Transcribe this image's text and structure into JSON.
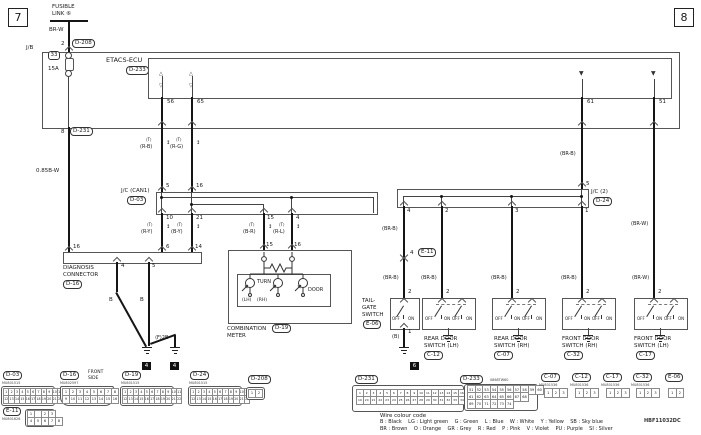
{
  "tabs": {
    "left": "7",
    "right": "8"
  },
  "doc": {
    "code": "HBF11032DC"
  },
  "supply": {
    "fusible1": "FUSIBLE",
    "fusible2": "LINK ⑥",
    "wire": "BR-W",
    "pin": "2",
    "conn": "D-208",
    "jb": "J/B",
    "fuse_no": "33",
    "fuse_rating": "15A",
    "out_pin": "8",
    "out_conn": "D-231",
    "out_wire": "0.85B-W"
  },
  "etacs": {
    "name": "ETACS-ECU",
    "conn": "D-233",
    "pins": {
      "p56": "56",
      "p65": "65",
      "p61": "61",
      "p51": "51"
    }
  },
  "sym": {
    "t": "⟨T⟩",
    "updown": "↕",
    "tri_up": "△",
    "tri_down": "▽",
    "tri_solid": "▼"
  },
  "can": {
    "w56": "(R-B)",
    "w65": "(R-G)",
    "w10": "(R-Y)",
    "w21": "(B-Y)",
    "w15": "(B-R)",
    "w4": "(R-L)"
  },
  "jc1": {
    "name": "J/C (CAN1)",
    "conn": "D-03",
    "top5": "5",
    "top16": "16",
    "b10": "10",
    "b21": "21",
    "b15": "15",
    "b4": "4"
  },
  "jc2": {
    "name": "J/C (2)",
    "conn": "D-24",
    "top5": "5",
    "b4": "4",
    "b2": "2",
    "b3": "3",
    "b1": "1",
    "w_in": "(BR-B)",
    "w_out": "(BR-W)"
  },
  "diag": {
    "name1": "DIAGNOSIS",
    "name2": "CONNECTOR",
    "conn": "D-16",
    "p16": "16",
    "p6": "6",
    "p14": "14",
    "p4": "4",
    "p5": "5",
    "w4": "B",
    "w5": "B",
    "f2b": "⟨F⟩2B",
    "g1": "4",
    "g2": "4"
  },
  "meter": {
    "p15": "15",
    "p16": "16",
    "turn": "TURN",
    "lh": "(LH)",
    "rh": "(RH)",
    "door": "DOOR",
    "name1": "COMBINATION",
    "name2": "METER",
    "conn": "D-19"
  },
  "tailgate": {
    "name1": "TAIL-",
    "name2": "GATE",
    "name3": "SWITCH",
    "conn": "E-06",
    "pin_top": "2",
    "pin_bot": "1",
    "w_top": "(BR-B)",
    "w_mid": "(BR-B)",
    "w_bot": "(B)",
    "off": "OFF",
    "on": "ON",
    "e11_pin": "4",
    "e11_conn": "E-11",
    "gnd": "6"
  },
  "doors": [
    {
      "w": "(BR-B)",
      "pin": "2",
      "name1": "REAR DOOR",
      "name2": "SWITCH (LH)",
      "conn": "C-12",
      "off": "OFF",
      "on": "ON"
    },
    {
      "w": "(BR-B)",
      "pin": "2",
      "name1": "REAR DOOR",
      "name2": "SWITCH (RH)",
      "conn": "C-07",
      "off": "OFF",
      "on": "ON"
    },
    {
      "w": "(BR-B)",
      "pin": "2",
      "name1": "FRONT DOOR",
      "name2": "SWITCH (RH)",
      "conn": "C-32",
      "off": "OFF",
      "on": "ON"
    },
    {
      "w": "(BR-W)",
      "pin": "2",
      "name1": "FRONT DOOR",
      "name2": "SWITCH (LH)",
      "conn": "C-17",
      "off": "OFF",
      "on": "ON"
    }
  ],
  "connectors": {
    "d03": {
      "label": "D-03",
      "code": "MU801515",
      "r1": [
        "1",
        "2",
        "3",
        "4",
        "5",
        "6",
        "7",
        "8",
        "9",
        "10",
        "11"
      ],
      "r2": [
        "12",
        "13",
        "14",
        "15",
        "16",
        "17",
        "18",
        "19",
        "20",
        "21",
        "22"
      ]
    },
    "e11": {
      "label": "E-11",
      "code": "MU801626",
      "r1": [
        "1",
        "",
        "2",
        "3"
      ],
      "r2": [
        "4",
        "5",
        "6",
        "7",
        "8"
      ]
    },
    "d16": {
      "label": "D-16",
      "note1": "FRONT",
      "note2": "SIDE",
      "code": "MU802597",
      "r1": [
        "1",
        "2",
        "3",
        "4",
        "5",
        "6",
        "7",
        "8"
      ],
      "r2": [
        "9",
        "10",
        "11",
        "12",
        "13",
        "14",
        "15",
        "16"
      ]
    },
    "d19": {
      "label": "D-19",
      "code": "MU801515",
      "r1": [
        "1",
        "2",
        "3",
        "4",
        "5",
        "6",
        "7",
        "8",
        "9",
        "10",
        "11"
      ],
      "r2": [
        "12",
        "13",
        "14",
        "15",
        "16",
        "17",
        "18",
        "19",
        "20",
        "21",
        "22"
      ]
    },
    "d24": {
      "label": "D-24",
      "code": "MU801515",
      "r1": [
        "1",
        "2",
        "3",
        "4",
        "5",
        "6",
        "7",
        "8",
        "9",
        "10",
        "11"
      ],
      "r2": [
        "12",
        "13",
        "14",
        "15",
        "16",
        "17",
        "18",
        "19",
        "20",
        "21",
        "22"
      ]
    },
    "d208": {
      "label": "D-208",
      "r1": [
        "1",
        "2"
      ]
    },
    "d231": {
      "label": "D-231",
      "r1": [
        "1",
        "2",
        "3",
        "4",
        "5",
        "6",
        "7",
        "8",
        "9",
        "10",
        "11",
        "12",
        "13",
        "14",
        "15",
        "16",
        "17",
        "18"
      ],
      "r2": [
        "19",
        "20",
        "21",
        "22",
        "23",
        "24",
        "25",
        "26",
        "27",
        "28",
        "29",
        "30",
        "31",
        "32",
        "33",
        "34",
        "35",
        "36"
      ]
    },
    "d233": {
      "label": "D-233",
      "code": "0868TW60",
      "r1": [
        "51",
        "52",
        "53",
        "54",
        "55",
        "56",
        "57",
        "58",
        "59",
        "60"
      ],
      "r2": [
        "61",
        "62",
        "63",
        "64",
        "65",
        "66",
        "67",
        "68"
      ],
      "r3": [
        "69",
        "70",
        "71",
        "72",
        "73",
        "74"
      ]
    },
    "c07": {
      "label": "C-07",
      "code": "MU801536",
      "r1": [
        "1",
        "2",
        "3"
      ]
    },
    "c12": {
      "label": "C-12",
      "code": "MU801536",
      "r1": [
        "1",
        "2",
        "3"
      ]
    },
    "c17": {
      "label": "C-17",
      "code": "MU801536",
      "r1": [
        "1",
        "2",
        "3"
      ]
    },
    "c32": {
      "label": "C-32",
      "code": "MU801536",
      "r1": [
        "1",
        "2",
        "3"
      ]
    },
    "e06": {
      "label": "E-06",
      "r1": [
        "1",
        "2"
      ]
    }
  },
  "legend": {
    "title": "Wire colour code",
    "line1": "B : Black    LG : Light green    G : Green    L : Blue    W : White    Y : Yellow    SB : Sky blue",
    "line2": "BR : Brown    O : Orange    GR : Grey    R : Red    P : Pink    V : Violet    PU : Purple    SI : Silver"
  }
}
